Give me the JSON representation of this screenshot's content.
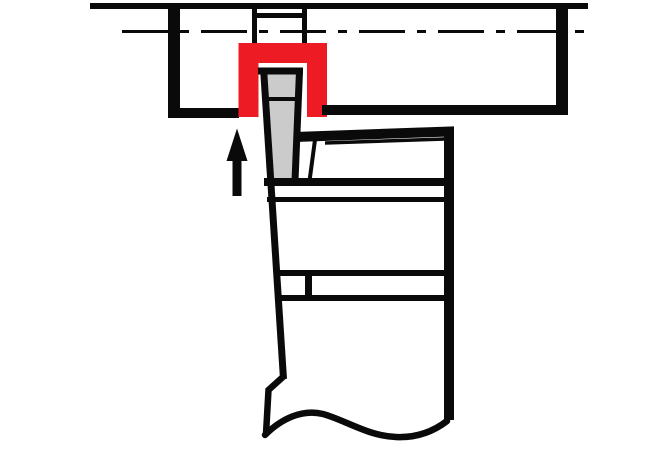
{
  "canvas": {
    "width": 670,
    "height": 460,
    "background": "#ffffff"
  },
  "palette": {
    "ink": "#0a0a0a",
    "highlight": "#ed1c24",
    "insert": "#cbcbcb"
  },
  "shapes": [
    {
      "name": "workpiece-top-edge",
      "type": "line",
      "p": [
        90,
        6,
        588,
        6
      ],
      "w": 6,
      "stroke": "ink"
    },
    {
      "name": "workpiece-centerline",
      "type": "line",
      "p": [
        122,
        31.5,
        588,
        31.5
      ],
      "w": 3,
      "stroke": "ink",
      "dash": "46 12 9 12"
    },
    {
      "name": "slot-left-wall",
      "type": "line",
      "p": [
        254.5,
        6,
        254.5,
        44
      ],
      "w": 5,
      "stroke": "ink"
    },
    {
      "name": "slot-right-wall",
      "type": "line",
      "p": [
        304.5,
        6,
        304.5,
        44
      ],
      "w": 5,
      "stroke": "ink"
    },
    {
      "name": "slot-bottom-edge",
      "type": "line",
      "p": [
        252,
        15.5,
        307,
        15.5
      ],
      "w": 5,
      "stroke": "ink"
    },
    {
      "name": "workpiece-left-edge",
      "type": "line",
      "p": [
        174,
        3,
        174,
        118
      ],
      "w": 12,
      "stroke": "ink"
    },
    {
      "name": "workpiece-right-edge",
      "type": "line",
      "p": [
        562,
        3,
        562,
        115
      ],
      "w": 12,
      "stroke": "ink"
    },
    {
      "name": "workpiece-bottom-left",
      "type": "line",
      "p": [
        168,
        113,
        239,
        113
      ],
      "w": 10,
      "stroke": "ink"
    },
    {
      "name": "groove-highlight",
      "type": "polyline",
      "pts": [
        [
          248.5,
          117
        ],
        [
          248.5,
          53
        ],
        [
          317,
          53
        ],
        [
          317,
          117
        ]
      ],
      "w": 20,
      "stroke": "highlight"
    },
    {
      "name": "workpiece-bottom-right",
      "type": "line",
      "p": [
        322,
        110,
        568,
        110
      ],
      "w": 10,
      "stroke": "ink"
    },
    {
      "name": "insert-fill",
      "type": "polygon",
      "pts": [
        [
          262,
          72
        ],
        [
          301,
          72
        ],
        [
          295,
          181
        ],
        [
          269,
          181
        ]
      ],
      "fill": "insert"
    },
    {
      "name": "insert-cutting-edge",
      "type": "line",
      "p": [
        258,
        71,
        303,
        71
      ],
      "w": 7,
      "stroke": "ink"
    },
    {
      "name": "insert-right-edge",
      "type": "line",
      "p": [
        299.5,
        71,
        295,
        181
      ],
      "w": 7,
      "stroke": "ink"
    },
    {
      "name": "insert-braze-line",
      "type": "line",
      "p": [
        263,
        99,
        299,
        99
      ],
      "w": 4,
      "stroke": "ink"
    },
    {
      "name": "clamp-diagonal-line",
      "type": "line",
      "p": [
        315.5,
        136,
        309.5,
        181
      ],
      "w": 4,
      "stroke": "ink"
    },
    {
      "name": "head-inner-line",
      "type": "line",
      "p": [
        325,
        143,
        445,
        139
      ],
      "w": 3.5,
      "stroke": "ink"
    },
    {
      "name": "upper-band-top-line",
      "type": "line",
      "p": [
        264,
        182,
        451,
        182
      ],
      "w": 8,
      "stroke": "ink"
    },
    {
      "name": "upper-band-bottom-line",
      "type": "line",
      "p": [
        267,
        199.5,
        451,
        199.5
      ],
      "w": 5,
      "stroke": "ink"
    },
    {
      "name": "lower-band-top-line",
      "type": "line",
      "p": [
        275,
        273,
        451,
        273
      ],
      "w": 6,
      "stroke": "ink"
    },
    {
      "name": "lower-band-bottom-line",
      "type": "line",
      "p": [
        277,
        298,
        451,
        298
      ],
      "w": 6,
      "stroke": "ink"
    },
    {
      "name": "lower-band-divider",
      "type": "line",
      "p": [
        308.5,
        270,
        308.5,
        301
      ],
      "w": 7,
      "stroke": "ink"
    },
    {
      "name": "shank-left-edge",
      "type": "line",
      "p": [
        263.5,
        68,
        283.5,
        379
      ],
      "w": 7,
      "stroke": "ink"
    },
    {
      "name": "shank-step",
      "type": "polyline",
      "pts": [
        [
          284,
          376
        ],
        [
          268.5,
          390
        ],
        [
          266,
          434
        ]
      ],
      "w": 6.5,
      "stroke": "ink"
    },
    {
      "name": "holder-outline",
      "type": "polyline",
      "pts": [
        [
          295,
          137
        ],
        [
          449,
          131.5
        ],
        [
          449,
          420
        ]
      ],
      "w": 10,
      "stroke": "ink"
    },
    {
      "name": "break-line",
      "type": "path",
      "d": "M265,435 C282,418 303,409 323,414 C345,420 368,436 396,437 C417,438 434,431 447,421",
      "w": 6.5,
      "stroke": "ink",
      "cap": "round"
    },
    {
      "name": "feed-arrow",
      "type": "polygon",
      "pts": [
        [
          237,
          128.5
        ],
        [
          247.5,
          161
        ],
        [
          241.5,
          161
        ],
        [
          241.5,
          196
        ],
        [
          232.5,
          196
        ],
        [
          232.5,
          161
        ],
        [
          226.5,
          161
        ]
      ],
      "fill": "ink"
    }
  ]
}
